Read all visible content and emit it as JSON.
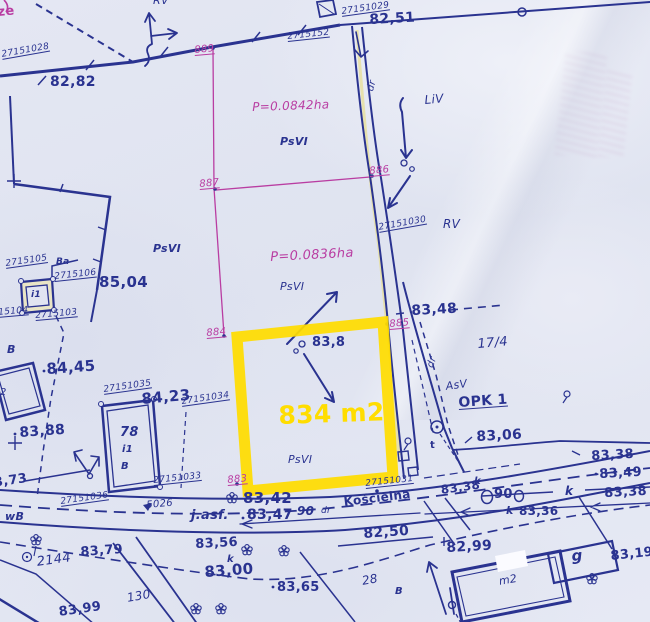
{
  "colors": {
    "paper": "#e1e4f1",
    "ink": "#2a3390",
    "magenta": "#b93da2",
    "yellow": "#ffdd00",
    "roadtint": "#e6dfa0"
  },
  "highlight": {
    "area_label": "834 m2",
    "land_use": "PsVI"
  },
  "parcel_areas": [
    "P=0.0842ha",
    "P=0.0836ha"
  ],
  "street": "Kościelna",
  "labels": [
    {
      "n": "text-ze",
      "t": "ze",
      "x": -3,
      "y": 6,
      "s": 13,
      "c": "magenta",
      "w": 700,
      "r": -5
    },
    {
      "n": "point-id-27151028",
      "t": "27151028",
      "x": 1,
      "y": 51,
      "s": 9,
      "u": 1,
      "fs": 1,
      "r": -10
    },
    {
      "n": "elev-82-82",
      "t": "82,82",
      "x": 50,
      "y": 75,
      "s": 14,
      "w": 700
    },
    {
      "n": "label-rv-top",
      "t": "RV",
      "x": 153,
      "y": -5,
      "s": 11,
      "fs": 1
    },
    {
      "n": "point-889",
      "t": "889",
      "x": 194,
      "y": 46,
      "s": 10,
      "c": "magenta",
      "u": 1,
      "fs": 1,
      "r": -5
    },
    {
      "n": "point-id-2715152",
      "t": "2715152",
      "x": 287,
      "y": 33,
      "s": 9,
      "u": 1,
      "fs": 1,
      "r": -6
    },
    {
      "n": "point-id-27151029",
      "t": "27151029",
      "x": 341,
      "y": 8,
      "s": 9,
      "u": 1,
      "fs": 1,
      "r": -8
    },
    {
      "n": "elev-82-51",
      "t": "82,51",
      "x": 369,
      "y": 13,
      "s": 14,
      "w": 700,
      "r": -3
    },
    {
      "n": "area-p-0842",
      "t": "P=0.0842ha",
      "x": 252,
      "y": 101,
      "s": 12,
      "c": "magenta",
      "fs": 1,
      "r": -2
    },
    {
      "n": "landuse-psvi-1",
      "t": "PsVI",
      "x": 280,
      "y": 136,
      "s": 11,
      "fs": 1,
      "w": 700
    },
    {
      "n": "label-dr-top",
      "t": "dr",
      "x": 366,
      "y": 90,
      "s": 10,
      "fs": 1,
      "r": -75
    },
    {
      "n": "label-liv",
      "t": "LiV",
      "x": 424,
      "y": 94,
      "s": 12,
      "fs": 1,
      "r": -5
    },
    {
      "n": "point-887",
      "t": "887",
      "x": 199,
      "y": 180,
      "s": 10,
      "c": "magenta",
      "u": 1,
      "fs": 1,
      "r": -5
    },
    {
      "n": "point-886",
      "t": "886",
      "x": 369,
      "y": 167,
      "s": 10,
      "c": "magenta",
      "u": 1,
      "fs": 1,
      "r": -5
    },
    {
      "n": "point-id-27151030",
      "t": "27151030",
      "x": 378,
      "y": 224,
      "s": 9,
      "u": 1,
      "fs": 1,
      "r": -10
    },
    {
      "n": "label-rv-mid",
      "t": "RV",
      "x": 443,
      "y": 218,
      "s": 12,
      "fs": 1
    },
    {
      "n": "area-p-0836",
      "t": "P=0.0836ha",
      "x": 270,
      "y": 251,
      "s": 13,
      "c": "magenta",
      "fs": 1,
      "r": -3
    },
    {
      "n": "landuse-psvi-2",
      "t": "PsVI",
      "x": 280,
      "y": 281,
      "s": 11,
      "fs": 1
    },
    {
      "n": "landuse-psvi-left",
      "t": "PsVI",
      "x": 153,
      "y": 243,
      "s": 11,
      "fs": 1,
      "w": 700
    },
    {
      "n": "elev-85-04",
      "t": "85,04",
      "x": 99,
      "y": 275,
      "s": 15,
      "w": 700
    },
    {
      "n": "point-id-2715105",
      "t": "2715105",
      "x": 5,
      "y": 260,
      "s": 9,
      "u": 1,
      "fs": 1,
      "r": -8
    },
    {
      "n": "label-ba",
      "t": "Ba",
      "x": 56,
      "y": 258,
      "s": 9,
      "fs": 1,
      "w": 700
    },
    {
      "n": "point-id-2715106",
      "t": "2715106",
      "x": 54,
      "y": 273,
      "s": 9,
      "u": 1,
      "fs": 1,
      "r": -6
    },
    {
      "n": "point-id-2715104",
      "t": "2715104",
      "x": -14,
      "y": 310,
      "s": 9,
      "u": 1,
      "fs": 1,
      "r": -5
    },
    {
      "n": "point-id-2715103",
      "t": "2715103",
      "x": 35,
      "y": 312,
      "s": 9,
      "u": 1,
      "fs": 1,
      "r": -5
    },
    {
      "n": "trafo-i1-label",
      "t": "i1",
      "x": 31,
      "y": 291,
      "s": 9,
      "fs": 1,
      "w": 700
    },
    {
      "n": "elev-83-48",
      "t": "83,48",
      "x": 411,
      "y": 304,
      "s": 14,
      "w": 700,
      "r": -3
    },
    {
      "n": "parcel-17-4",
      "t": "17/4",
      "x": 477,
      "y": 338,
      "s": 13,
      "fs": 1,
      "r": -5
    },
    {
      "n": "point-884",
      "t": "884",
      "x": 206,
      "y": 329,
      "s": 10,
      "c": "magenta",
      "u": 1,
      "fs": 1,
      "r": -5
    },
    {
      "n": "point-885",
      "t": "885",
      "x": 389,
      "y": 320,
      "s": 10,
      "c": "magenta",
      "u": 1,
      "fs": 1,
      "r": -5
    },
    {
      "n": "elev-83-8",
      "t": "83,8",
      "x": 312,
      "y": 336,
      "s": 13,
      "w": 700
    },
    {
      "n": "highlight-area-label",
      "t": "834 m2",
      "x": 278,
      "y": 403,
      "s": 25,
      "c": "yellow",
      "w": 700,
      "r": -2
    },
    {
      "n": "landuse-psvi-3",
      "t": "PsVI",
      "x": 288,
      "y": 454,
      "s": 11,
      "fs": 1
    },
    {
      "n": "label-b-left",
      "t": "B",
      "x": 7,
      "y": 344,
      "s": 11,
      "fs": 1,
      "w": 700
    },
    {
      "n": "elev-84-45",
      "t": "84,45",
      "x": 46,
      "y": 362,
      "s": 15,
      "w": 700,
      "r": -4
    },
    {
      "n": "building-m2-left",
      "t": "m2",
      "x": -10,
      "y": 388,
      "s": 10,
      "fs": 1
    },
    {
      "n": "elev-83-88",
      "t": "83,88",
      "x": 19,
      "y": 426,
      "s": 14,
      "w": 700,
      "r": -4
    },
    {
      "n": "point-id-27151035",
      "t": "27151035",
      "x": 103,
      "y": 386,
      "s": 9,
      "u": 1,
      "fs": 1,
      "r": -8
    },
    {
      "n": "elev-84-23",
      "t": "84,23",
      "x": 141,
      "y": 392,
      "s": 15,
      "w": 700,
      "r": -5
    },
    {
      "n": "point-id-27151034",
      "t": "27151034",
      "x": 181,
      "y": 398,
      "s": 9,
      "u": 1,
      "fs": 1,
      "r": -8
    },
    {
      "n": "house-number-78",
      "t": "78",
      "x": 120,
      "y": 426,
      "s": 13,
      "fs": 1,
      "w": 700
    },
    {
      "n": "house-i1",
      "t": "i1",
      "x": 122,
      "y": 445,
      "s": 10,
      "fs": 1,
      "w": 700
    },
    {
      "n": "house-b",
      "t": "B",
      "x": 121,
      "y": 462,
      "s": 10,
      "fs": 1,
      "w": 700
    },
    {
      "n": "point-id-27151033",
      "t": "27151033",
      "x": 153,
      "y": 477,
      "s": 9,
      "u": 1,
      "fs": 1,
      "r": -6
    },
    {
      "n": "point-883",
      "t": "883",
      "x": 227,
      "y": 476,
      "s": 10,
      "c": "magenta",
      "u": 1,
      "fs": 1,
      "r": -5
    },
    {
      "n": "point-id-27151031",
      "t": "27151031",
      "x": 365,
      "y": 480,
      "s": 9,
      "u": 1,
      "fs": 1,
      "r": -6
    },
    {
      "n": "point-id-27151036",
      "t": "27151036",
      "x": 60,
      "y": 498,
      "s": 9,
      "u": 1,
      "fs": 1,
      "r": -8
    },
    {
      "n": "label-opk1",
      "t": "OPK 1",
      "x": 458,
      "y": 396,
      "s": 14,
      "w": 700,
      "u": 1,
      "r": -4
    },
    {
      "n": "label-asv",
      "t": "AsV",
      "x": 445,
      "y": 381,
      "s": 11,
      "fs": 1,
      "r": -8
    },
    {
      "n": "label-dr-mid",
      "t": "dr",
      "x": 426,
      "y": 366,
      "s": 10,
      "fs": 1,
      "r": -70
    },
    {
      "n": "label-t",
      "t": "t",
      "x": 430,
      "y": 441,
      "s": 10,
      "w": 700
    },
    {
      "n": "elev-83-06",
      "t": "83,06",
      "x": 476,
      "y": 430,
      "s": 14,
      "w": 700,
      "r": -3
    },
    {
      "n": "elev-83-38-a",
      "t": "83,38",
      "x": 591,
      "y": 450,
      "s": 13,
      "w": 700,
      "r": -3
    },
    {
      "n": "elev-83-49",
      "t": "83,49",
      "x": 599,
      "y": 468,
      "s": 13,
      "w": 700,
      "r": -3
    },
    {
      "n": "elev-83-38-b",
      "t": "83,38",
      "x": 604,
      "y": 487,
      "s": 13,
      "w": 700,
      "r": -3
    },
    {
      "n": "elev-83-38-k",
      "t": "83,38",
      "x": 440,
      "y": 484,
      "s": 12,
      "w": 700,
      "r": -8
    },
    {
      "n": "label-k-sup",
      "t": "k",
      "x": 474,
      "y": 477,
      "s": 10,
      "fs": 1,
      "w": 700
    },
    {
      "n": "pipe-diameter-90",
      "t": "90",
      "x": 494,
      "y": 488,
      "s": 13,
      "w": 700
    },
    {
      "n": "label-k-line",
      "t": "k",
      "x": 565,
      "y": 485,
      "s": 12,
      "fs": 1,
      "w": 700
    },
    {
      "n": "label-k-2",
      "t": "k",
      "x": 506,
      "y": 505,
      "s": 11,
      "fs": 1,
      "w": 700
    },
    {
      "n": "elev-83-36",
      "t": "83,36",
      "x": 519,
      "y": 505,
      "s": 12,
      "w": 700
    },
    {
      "n": "label-5026",
      "t": "5026",
      "x": 146,
      "y": 501,
      "s": 10,
      "fs": 1,
      "r": -5
    },
    {
      "n": "elev-83-42",
      "t": "83,42",
      "x": 243,
      "y": 491,
      "s": 15,
      "w": 700
    },
    {
      "n": "label-jasf",
      "t": "j.asf.",
      "x": 191,
      "y": 509,
      "s": 13,
      "fs": 1,
      "w": 700
    },
    {
      "n": "elev-83-47",
      "t": "83,47",
      "x": 247,
      "y": 508,
      "s": 14,
      "w": 700
    },
    {
      "n": "label-90-road",
      "t": "90",
      "x": 297,
      "y": 505,
      "s": 12,
      "fs": 1,
      "w": 700
    },
    {
      "n": "label-dr-road",
      "t": "dr",
      "x": 321,
      "y": 507,
      "s": 9,
      "fs": 1
    },
    {
      "n": "street-koscielna",
      "t": "Kościelna",
      "x": 343,
      "y": 496,
      "s": 12,
      "w": 700,
      "r": -7
    },
    {
      "n": "elev-82-50",
      "t": "82,50",
      "x": 363,
      "y": 527,
      "s": 14,
      "w": 700,
      "r": -4
    },
    {
      "n": "elev-83-56",
      "t": "83,56",
      "x": 195,
      "y": 538,
      "s": 13,
      "w": 700,
      "r": -3
    },
    {
      "n": "elev-83-00",
      "t": "83,00",
      "x": 204,
      "y": 565,
      "s": 15,
      "w": 700,
      "r": -4
    },
    {
      "n": "label-k-3",
      "t": "k",
      "x": 227,
      "y": 555,
      "s": 10,
      "fs": 1,
      "w": 700
    },
    {
      "n": "elev-83-65",
      "t": "83,65",
      "x": 277,
      "y": 581,
      "s": 13,
      "w": 700
    },
    {
      "n": "parcel-28",
      "t": "28",
      "x": 361,
      "y": 575,
      "s": 12,
      "fs": 1,
      "r": -10
    },
    {
      "n": "label-b-bottom",
      "t": "B",
      "x": 395,
      "y": 587,
      "s": 10,
      "fs": 1,
      "w": 700
    },
    {
      "n": "parcel-130",
      "t": "130",
      "x": 126,
      "y": 592,
      "s": 12,
      "fs": 1,
      "r": -10
    },
    {
      "n": "elev-83-99",
      "t": "83,99",
      "x": 58,
      "y": 606,
      "s": 13,
      "w": 700,
      "r": -8
    },
    {
      "n": "elev-83-79",
      "t": "83,79",
      "x": 80,
      "y": 546,
      "s": 13,
      "w": 700,
      "r": -4
    },
    {
      "n": "parcel-2144",
      "t": "2144",
      "x": 36,
      "y": 556,
      "s": 13,
      "fs": 1,
      "r": -8
    },
    {
      "n": "label-wb",
      "t": "wB",
      "x": 5,
      "y": 511,
      "s": 11,
      "fs": 1,
      "w": 700
    },
    {
      "n": "elev-83-73",
      "t": "83,73",
      "x": -16,
      "y": 478,
      "s": 13,
      "w": 700,
      "r": -8
    },
    {
      "n": "elev-82-99",
      "t": "82,99",
      "x": 446,
      "y": 541,
      "s": 14,
      "w": 700,
      "r": -3
    },
    {
      "n": "building-m2-right",
      "t": "m2",
      "x": 498,
      "y": 576,
      "s": 11,
      "fs": 1,
      "r": -10
    },
    {
      "n": "building-g",
      "t": "g",
      "x": 571,
      "y": 549,
      "s": 15,
      "fs": 1,
      "w": 700,
      "r": -5
    },
    {
      "n": "elev-83-19",
      "t": "83,19",
      "x": 610,
      "y": 550,
      "s": 13,
      "w": 700,
      "r": -6
    }
  ]
}
